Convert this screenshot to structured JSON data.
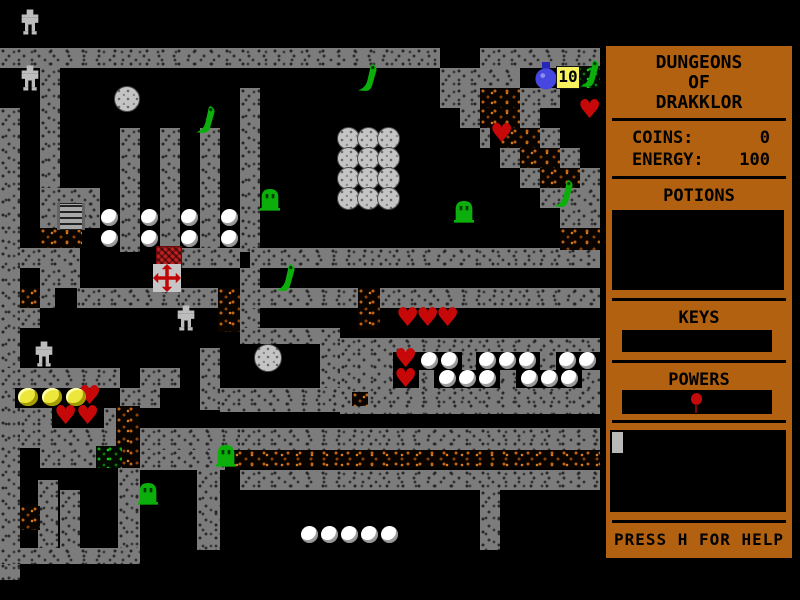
{
  "sidebar": {
    "panel_color": "#b26110",
    "title_lines": [
      "DUNGEONS",
      "OF",
      "DRAKKLOR"
    ],
    "stats": [
      {
        "label": "COINS:",
        "value": "0"
      },
      {
        "label": "ENERGY:",
        "value": "100"
      }
    ],
    "sections": {
      "potions": "POTIONS",
      "keys": "KEYS",
      "powers": "POWERS"
    },
    "help_text": "PRESS H FOR HELP"
  },
  "map": {
    "colors": {
      "wall_gray": "#7c7c7c",
      "rubble_orange": "#c06414",
      "moss_green": "#0fae0f",
      "enemy_green": "#0cа80c",
      "heart_red": "#c60808",
      "coin_yellow": "#ece73a",
      "pearl_white": "#ffffff",
      "flask_blue": "#4646e0",
      "counter_bg": "#f7f25e"
    },
    "counter_badge": "10",
    "walls": [
      [
        0,
        48,
        440,
        20
      ],
      [
        480,
        48,
        120,
        20
      ],
      [
        0,
        108,
        20,
        472
      ],
      [
        40,
        68,
        20,
        120
      ],
      [
        40,
        188,
        60,
        40
      ],
      [
        120,
        128,
        20,
        124
      ],
      [
        160,
        128,
        20,
        124
      ],
      [
        200,
        128,
        20,
        124
      ],
      [
        240,
        88,
        20,
        164
      ],
      [
        440,
        68,
        80,
        20
      ],
      [
        440,
        88,
        40,
        20
      ],
      [
        520,
        88,
        40,
        20
      ],
      [
        460,
        108,
        20,
        20
      ],
      [
        520,
        108,
        20,
        20
      ],
      [
        480,
        128,
        20,
        20
      ],
      [
        540,
        128,
        20,
        20
      ],
      [
        500,
        148,
        20,
        20
      ],
      [
        560,
        148,
        20,
        20
      ],
      [
        520,
        168,
        20,
        20
      ],
      [
        580,
        168,
        20,
        20
      ],
      [
        540,
        188,
        60,
        20
      ],
      [
        560,
        208,
        40,
        20
      ],
      [
        20,
        248,
        60,
        20
      ],
      [
        180,
        248,
        60,
        20
      ],
      [
        250,
        248,
        350,
        20
      ],
      [
        240,
        268,
        20,
        60
      ],
      [
        40,
        268,
        40,
        40
      ],
      [
        80,
        288,
        100,
        20
      ],
      [
        180,
        288,
        40,
        20
      ],
      [
        240,
        288,
        120,
        20
      ],
      [
        380,
        288,
        220,
        20
      ],
      [
        20,
        308,
        20,
        20
      ],
      [
        240,
        328,
        80,
        16
      ],
      [
        320,
        328,
        20,
        84
      ],
      [
        200,
        348,
        20,
        62
      ],
      [
        340,
        338,
        260,
        76
      ],
      [
        220,
        388,
        120,
        24
      ],
      [
        0,
        368,
        120,
        20
      ],
      [
        140,
        368,
        40,
        20
      ],
      [
        120,
        388,
        40,
        20
      ],
      [
        20,
        408,
        36,
        20
      ],
      [
        104,
        408,
        34,
        20
      ],
      [
        20,
        428,
        100,
        20
      ],
      [
        140,
        428,
        100,
        22
      ],
      [
        240,
        428,
        360,
        22
      ],
      [
        40,
        448,
        56,
        20
      ],
      [
        140,
        450,
        85,
        20
      ],
      [
        38,
        480,
        20,
        70
      ],
      [
        60,
        490,
        20,
        60
      ],
      [
        118,
        468,
        22,
        80
      ],
      [
        197,
        470,
        23,
        80
      ],
      [
        240,
        470,
        360,
        20
      ],
      [
        480,
        490,
        20,
        60
      ],
      [
        0,
        548,
        140,
        16
      ]
    ],
    "rubble": [
      [
        480,
        88,
        40,
        20
      ],
      [
        480,
        108,
        40,
        20
      ],
      [
        500,
        128,
        40,
        20
      ],
      [
        520,
        148,
        40,
        20
      ],
      [
        540,
        168,
        40,
        20
      ],
      [
        560,
        228,
        40,
        22
      ],
      [
        40,
        228,
        42,
        20
      ],
      [
        20,
        288,
        20,
        20
      ],
      [
        218,
        288,
        22,
        44
      ],
      [
        358,
        288,
        22,
        42
      ],
      [
        352,
        392,
        16,
        14
      ],
      [
        116,
        406,
        24,
        62
      ],
      [
        20,
        506,
        20,
        24
      ],
      [
        225,
        450,
        375,
        18
      ]
    ],
    "green_rubble": [
      [
        576,
        66,
        24,
        22
      ],
      [
        96,
        446,
        26,
        22
      ]
    ],
    "pockets": [
      [
        490,
        126,
        28,
        22
      ],
      [
        55,
        288,
        22,
        20
      ],
      [
        15,
        388,
        104,
        20
      ],
      [
        52,
        408,
        52,
        20
      ],
      [
        393,
        352,
        26,
        18
      ],
      [
        418,
        352,
        44,
        18
      ],
      [
        476,
        352,
        64,
        18
      ],
      [
        556,
        352,
        44,
        18
      ],
      [
        393,
        370,
        26,
        18
      ],
      [
        434,
        370,
        66,
        18
      ],
      [
        516,
        370,
        66,
        18
      ]
    ],
    "sprites": [
      {
        "type": "golem",
        "x": 20,
        "y": 8
      },
      {
        "type": "golem",
        "x": 20,
        "y": 64
      },
      {
        "type": "golem",
        "x": 176,
        "y": 304
      },
      {
        "type": "golem",
        "x": 34,
        "y": 340
      },
      {
        "type": "ball",
        "x": 114,
        "y": 86,
        "w": 24,
        "h": 24
      },
      {
        "type": "ball",
        "x": 254,
        "y": 344,
        "w": 26,
        "h": 26
      },
      {
        "type": "ball",
        "x": 337,
        "y": 127
      },
      {
        "type": "ball",
        "x": 357,
        "y": 127
      },
      {
        "type": "ball",
        "x": 377,
        "y": 127
      },
      {
        "type": "ball",
        "x": 337,
        "y": 147
      },
      {
        "type": "ball",
        "x": 357,
        "y": 147
      },
      {
        "type": "ball",
        "x": 377,
        "y": 147
      },
      {
        "type": "ball",
        "x": 337,
        "y": 167
      },
      {
        "type": "ball",
        "x": 357,
        "y": 167
      },
      {
        "type": "ball",
        "x": 377,
        "y": 167
      },
      {
        "type": "ball",
        "x": 337,
        "y": 187
      },
      {
        "type": "ball",
        "x": 357,
        "y": 187
      },
      {
        "type": "ball",
        "x": 377,
        "y": 187
      },
      {
        "type": "pearl",
        "x": 101,
        "y": 209
      },
      {
        "type": "pearl",
        "x": 141,
        "y": 209
      },
      {
        "type": "pearl",
        "x": 181,
        "y": 209
      },
      {
        "type": "pearl",
        "x": 221,
        "y": 209
      },
      {
        "type": "pearl",
        "x": 101,
        "y": 230
      },
      {
        "type": "pearl",
        "x": 141,
        "y": 230
      },
      {
        "type": "pearl",
        "x": 181,
        "y": 230
      },
      {
        "type": "pearl",
        "x": 221,
        "y": 230
      },
      {
        "type": "pearl",
        "x": 421,
        "y": 352
      },
      {
        "type": "pearl",
        "x": 441,
        "y": 352
      },
      {
        "type": "pearl",
        "x": 479,
        "y": 352
      },
      {
        "type": "pearl",
        "x": 499,
        "y": 352
      },
      {
        "type": "pearl",
        "x": 519,
        "y": 352
      },
      {
        "type": "pearl",
        "x": 559,
        "y": 352
      },
      {
        "type": "pearl",
        "x": 579,
        "y": 352
      },
      {
        "type": "pearl",
        "x": 439,
        "y": 370
      },
      {
        "type": "pearl",
        "x": 459,
        "y": 370
      },
      {
        "type": "pearl",
        "x": 479,
        "y": 370
      },
      {
        "type": "pearl",
        "x": 521,
        "y": 370
      },
      {
        "type": "pearl",
        "x": 541,
        "y": 370
      },
      {
        "type": "pearl",
        "x": 561,
        "y": 370
      },
      {
        "type": "pearl",
        "x": 301,
        "y": 526
      },
      {
        "type": "pearl",
        "x": 321,
        "y": 526
      },
      {
        "type": "pearl",
        "x": 341,
        "y": 526
      },
      {
        "type": "pearl",
        "x": 361,
        "y": 526
      },
      {
        "type": "pearl",
        "x": 381,
        "y": 526
      },
      {
        "type": "heart",
        "x": 578,
        "y": 100
      },
      {
        "type": "heart",
        "x": 490,
        "y": 124
      },
      {
        "type": "heart",
        "x": 396,
        "y": 308
      },
      {
        "type": "heart",
        "x": 416,
        "y": 308
      },
      {
        "type": "heart",
        "x": 436,
        "y": 308
      },
      {
        "type": "heart",
        "x": 394,
        "y": 349
      },
      {
        "type": "heart",
        "x": 394,
        "y": 369
      },
      {
        "type": "heart",
        "x": 78,
        "y": 386
      },
      {
        "type": "heart",
        "x": 54,
        "y": 406
      },
      {
        "type": "heart",
        "x": 76,
        "y": 406
      },
      {
        "type": "coin",
        "x": 18,
        "y": 388
      },
      {
        "type": "coin",
        "x": 42,
        "y": 388
      },
      {
        "type": "coin",
        "x": 66,
        "y": 388
      },
      {
        "type": "ghost",
        "x": 260,
        "y": 186
      },
      {
        "type": "ghost",
        "x": 454,
        "y": 198
      },
      {
        "type": "ghost",
        "x": 216,
        "y": 442
      },
      {
        "type": "ghost",
        "x": 138,
        "y": 480
      },
      {
        "type": "slug",
        "x": 358,
        "y": 62
      },
      {
        "type": "slug",
        "x": 196,
        "y": 104
      },
      {
        "type": "slug",
        "x": 580,
        "y": 58
      },
      {
        "type": "slug",
        "x": 554,
        "y": 178
      },
      {
        "type": "slug",
        "x": 276,
        "y": 262
      },
      {
        "type": "ladder",
        "x": 57,
        "y": 203
      },
      {
        "type": "gem",
        "x": 156,
        "y": 246
      },
      {
        "type": "cross",
        "x": 153,
        "y": 264
      },
      {
        "type": "flask",
        "x": 534,
        "y": 62
      },
      {
        "type": "counter",
        "x": 556,
        "y": 66,
        "text": "10"
      }
    ]
  }
}
